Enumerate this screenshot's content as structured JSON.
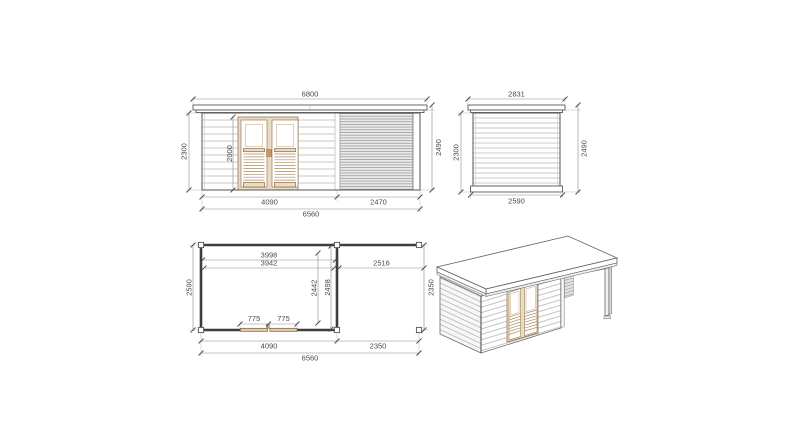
{
  "document": {
    "kind": "garden house technical drawing",
    "background": "#ffffff"
  },
  "colors": {
    "line": "#5a5a5a",
    "dim_line": "#8c8c8c",
    "dim_text": "#4a4a4a",
    "siding_line": "#b8b8b8",
    "hatch_fill": "#eaeaea",
    "hatch_line": "#9a9a9a",
    "wood_fill": "#e9dcc3",
    "wood_stroke": "#8a6842",
    "plan_wall": "#3d3d3d",
    "plan_door_fill": "#dccdb4"
  },
  "views": {
    "front_elevation": {
      "dims": {
        "roof_width": "6800",
        "wall_height_left": "2300",
        "door_height": "2000",
        "total_height_right": "2490",
        "cabin_width": "4090",
        "canopy_width": "2470",
        "total_width": "6560"
      }
    },
    "side_elevation": {
      "dims": {
        "roof_depth": "2831",
        "wall_height_left": "2300",
        "total_height_right": "2490",
        "base_depth": "2590"
      }
    },
    "floor_plan": {
      "dims": {
        "interior_width_a": "3998",
        "interior_width_b": "3942",
        "canopy_interior_width": "2516",
        "depth_left": "2590",
        "interior_depth_a": "2442",
        "interior_depth_b": "2498",
        "canopy_depth_right": "2350",
        "door_leaf_left": "775",
        "door_leaf_right": "775",
        "cabin_width": "4090",
        "canopy_width": "2350",
        "total_width": "6560"
      }
    },
    "perspective_3d": {}
  }
}
